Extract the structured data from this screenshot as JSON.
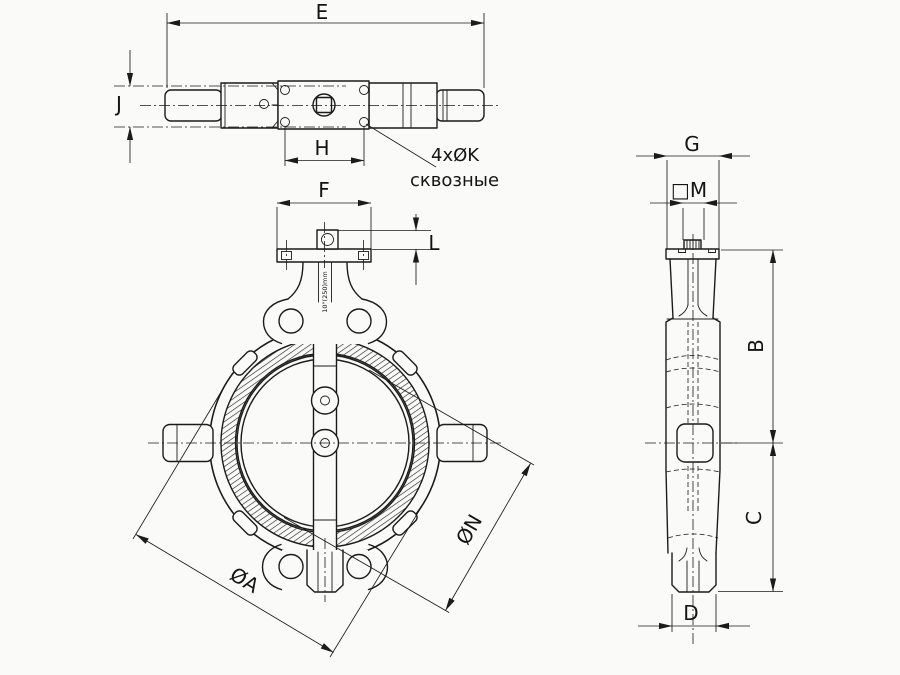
{
  "drawing": {
    "kind": "butterfly-valve-three-view-technical-drawing",
    "colors": {
      "background": "#fafaf8",
      "line": "#1b1b1b"
    },
    "labels": {
      "e": "E",
      "j": "J",
      "h": "H",
      "f": "F",
      "l": "L",
      "g": "G",
      "m": "□M",
      "b": "B",
      "c": "C",
      "d": "D",
      "dia_a": "ØA",
      "dia_n": "ØN",
      "holes_qty": "4xØK",
      "holes_note": "сквозные",
      "neck_marking": "10\"(250)mm"
    }
  }
}
